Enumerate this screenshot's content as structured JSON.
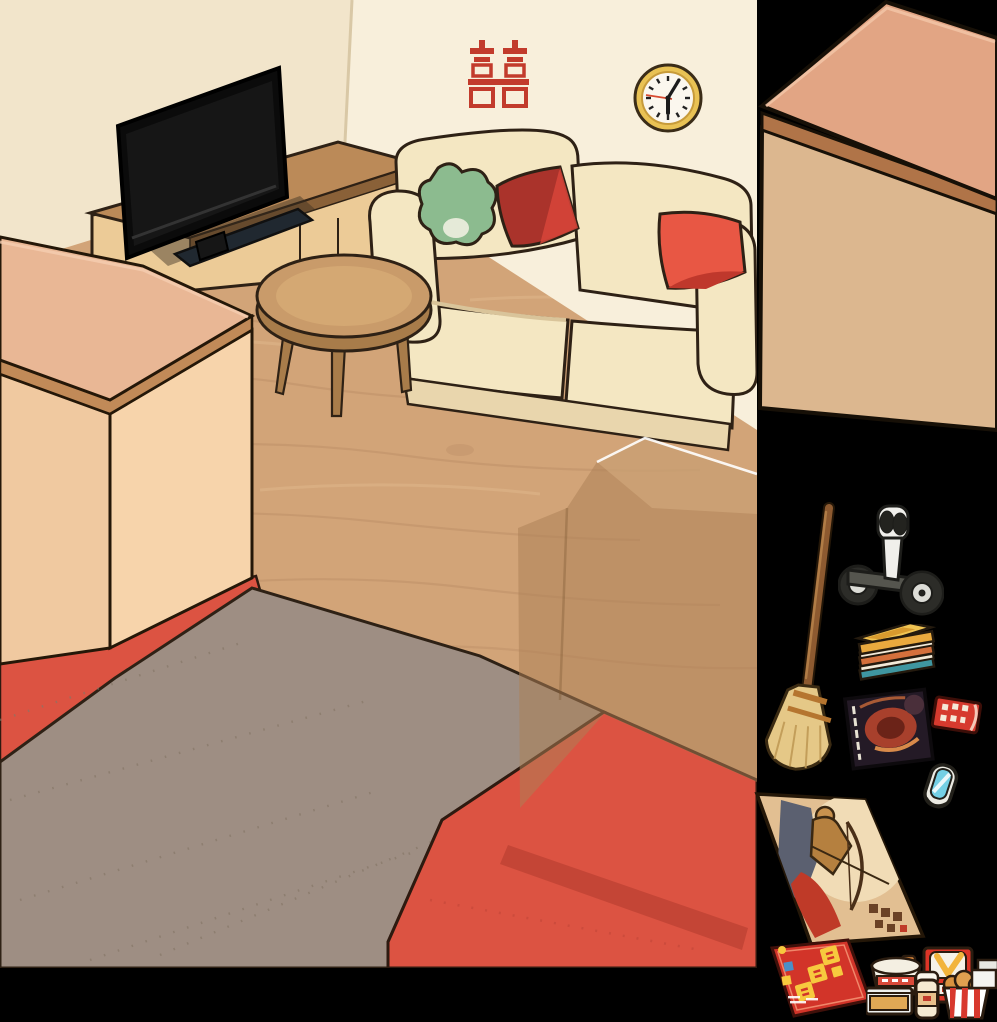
{
  "scene": {
    "type": "room-decorating-game",
    "room": {
      "wall_color": "#f8efdb",
      "left_wall_color": "#f2e5cb",
      "floor_wood_color": "#d2a478",
      "carpet_gray_color": "#9e8e83",
      "carpet_red_color": "#dc5342",
      "decor": {
        "double_happiness_symbol": "囍",
        "double_happiness_color": "#c23b2c",
        "clock_time": "6:05"
      },
      "furniture": [
        "flat-screen-tv",
        "tv-cabinet",
        "cream-sofa",
        "green-pillow",
        "dark-red-pillow",
        "bright-red-pillow",
        "round-coffee-table",
        "foreground-storage-box"
      ],
      "placement_ghost": {
        "item": "storage-box",
        "style": "translucent-tan-with-white-edge"
      }
    },
    "tray": {
      "items": [
        {
          "id": "storage-box",
          "label": "large storage box"
        },
        {
          "id": "segway",
          "label": "self-balancing scooter"
        },
        {
          "id": "broom",
          "label": "straw broom"
        },
        {
          "id": "books",
          "label": "stack of books"
        },
        {
          "id": "magazine",
          "label": "dark sci-fi novel"
        },
        {
          "id": "coupons",
          "label": "red coupon tickets"
        },
        {
          "id": "glasses",
          "label": "folded blue glasses"
        },
        {
          "id": "poster",
          "label": "archer art poster"
        },
        {
          "id": "flyer",
          "label": "red sale flyer",
          "text": "特惠狂欢购",
          "text_color": "#f7c93e",
          "bg_color": "#d23429"
        },
        {
          "id": "fastfood",
          "label": "fast food set",
          "bag_brand": "华莱士",
          "parts": [
            "instant-noodle-cup",
            "takeout-box",
            "milk-tea-cup",
            "fried-chicken-bucket",
            "red-bag",
            "napkin-boxes"
          ]
        }
      ]
    }
  }
}
